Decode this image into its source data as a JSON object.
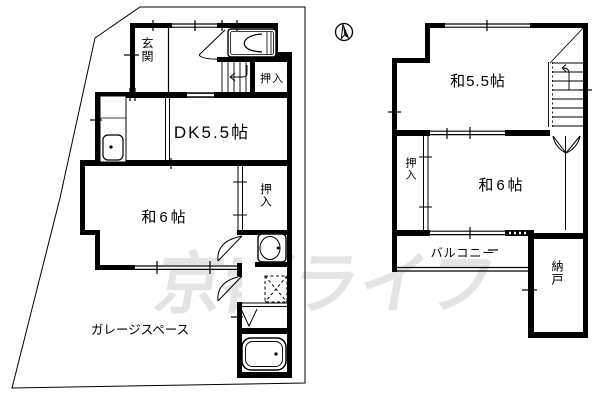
{
  "colors": {
    "background": "#ffffff",
    "line": "#000000",
    "watermark": "#e4e4e4"
  },
  "watermark": {
    "text": "京都ライフ"
  },
  "compass": {
    "icon": "north-arrow"
  },
  "floor1": {
    "labels": {
      "genkan": "玄関",
      "oshiire_upper": "押入",
      "dk": "DK5.5帖",
      "washitsu6": "和6帖",
      "oshiire_lower": "押入",
      "garage": "ガレージスペース"
    }
  },
  "floor2": {
    "labels": {
      "washitsu55": "和5.5帖",
      "oshiire": "押入",
      "washitsu6": "和6帖",
      "balcony": "バルコニー",
      "nando": "納戸"
    }
  }
}
